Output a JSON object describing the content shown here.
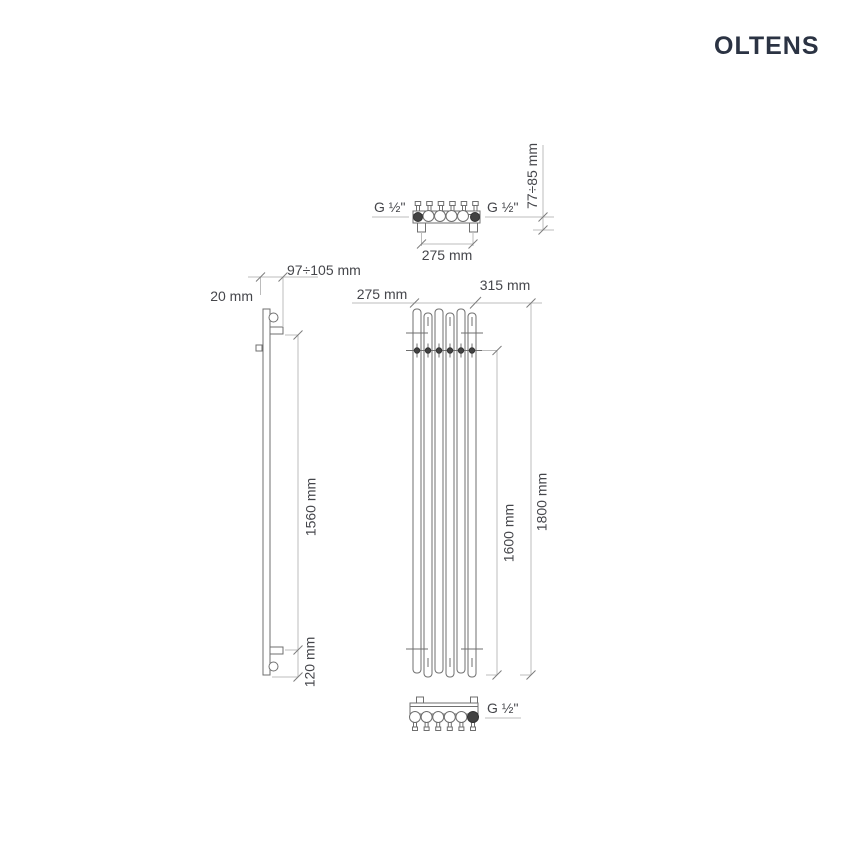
{
  "brand": {
    "name": "OLTENS"
  },
  "drawing": {
    "top_view": {
      "g_left": "G ½\"",
      "g_right": "G ½\"",
      "pitch": "275 mm",
      "wall_distance": "77÷85 mm"
    },
    "side_view": {
      "depth": "20 mm",
      "mount_depth": "97÷105 mm",
      "bracket_span": "1560 mm",
      "bottom_offset": "120 mm"
    },
    "front_view": {
      "pitch": "275 mm",
      "width": "315 mm",
      "connection_span": "1600 mm",
      "height": "1800 mm"
    },
    "bottom_view": {
      "g": "G ½\""
    }
  },
  "colors": {
    "logo": "#2b3343",
    "object_line": "#6f6f6f",
    "dimension_line": "#bcbcbc",
    "label_text": "#45464b",
    "background": "#ffffff"
  }
}
